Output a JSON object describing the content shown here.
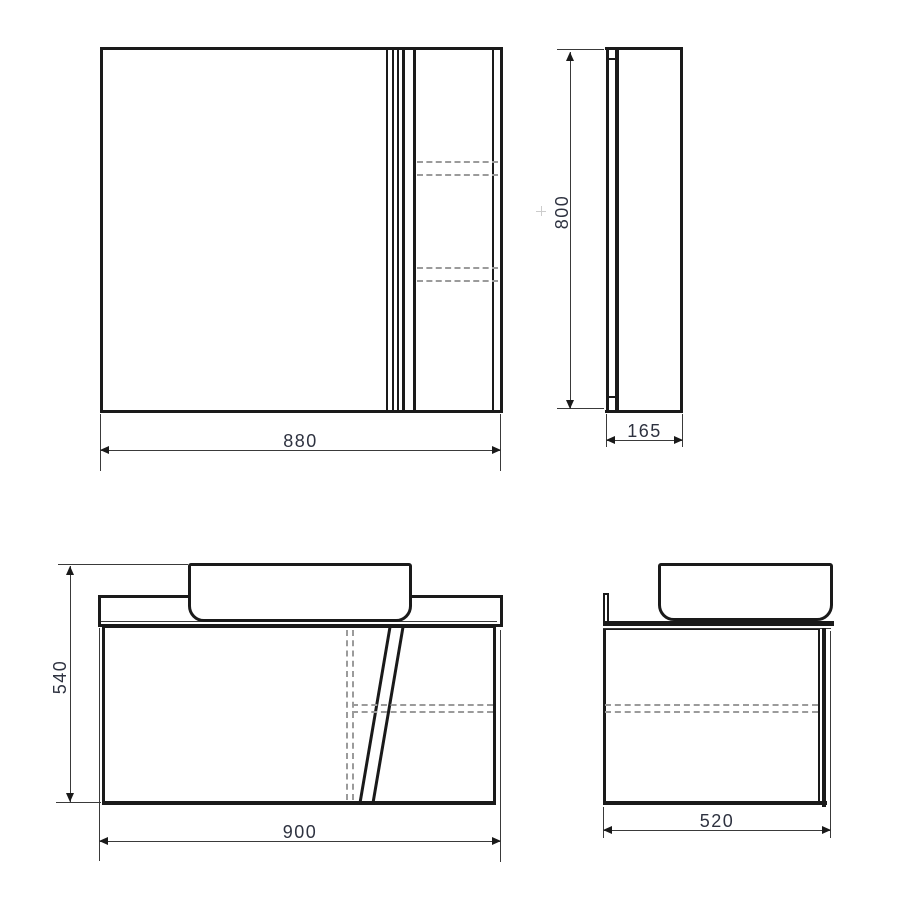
{
  "drawing": {
    "type": "technical-dimension-drawing",
    "subject": "mirror cabinet and vanity unit with basin, four orthographic views"
  },
  "dimensions": {
    "mirror_front_width": "880",
    "mirror_side_height": "800",
    "mirror_side_depth": "165",
    "vanity_front_height": "540",
    "vanity_front_width": "900",
    "vanity_side_depth": "520"
  },
  "colors": {
    "line": "#1a1a1a",
    "dimension_line": "#3a3a3a",
    "dashed_line": "#9b9b9b",
    "label_text": "#2e3240",
    "background": "#ffffff"
  }
}
